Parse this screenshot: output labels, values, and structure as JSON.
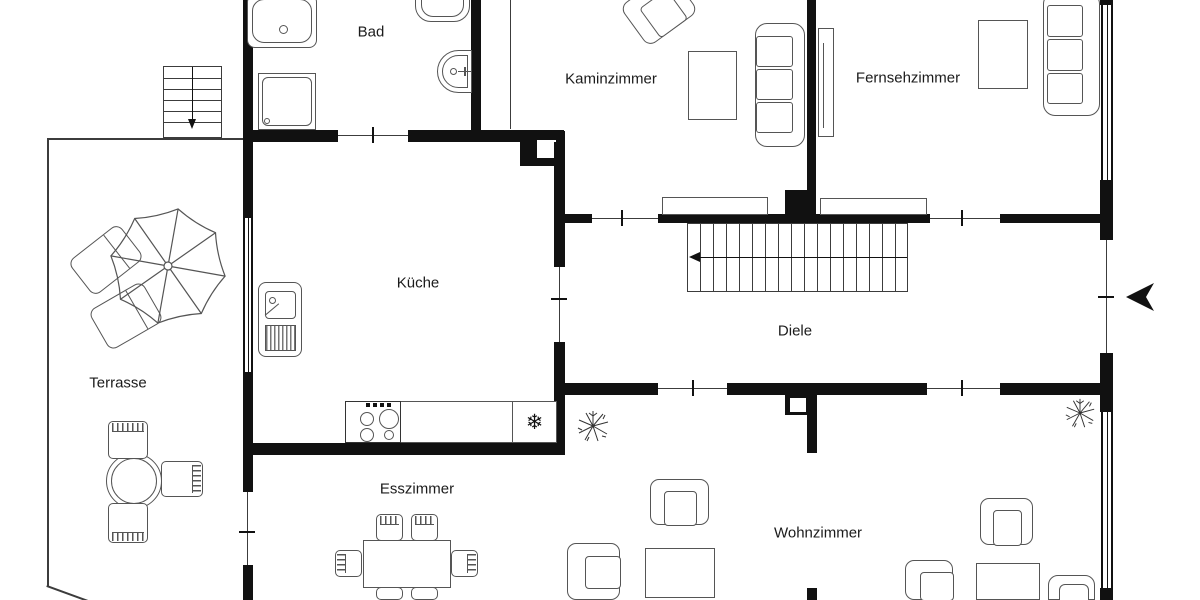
{
  "rooms": {
    "bad": {
      "label": "Bad"
    },
    "kaminzimmer": {
      "label": "Kaminzimmer"
    },
    "fernsehzimmer": {
      "label": "Fernsehzimmer"
    },
    "kueche": {
      "label": "Küche"
    },
    "diele": {
      "label": "Diele"
    },
    "terrasse": {
      "label": "Terrasse"
    },
    "esszimmer": {
      "label": "Esszimmer"
    },
    "wohnzimmer": {
      "label": "Wohnzimmer"
    }
  },
  "symbols": {
    "freezer": "❄",
    "entry_arrow": "left-pointing-entry-arrow",
    "stair_direction_diele": "left",
    "stair_direction_exterior": "down"
  },
  "colors": {
    "wall": "#111111",
    "thin_line": "#3c3c3c",
    "furniture_stroke": "#555555",
    "background": "#ffffff",
    "text": "#1b1b1b"
  }
}
